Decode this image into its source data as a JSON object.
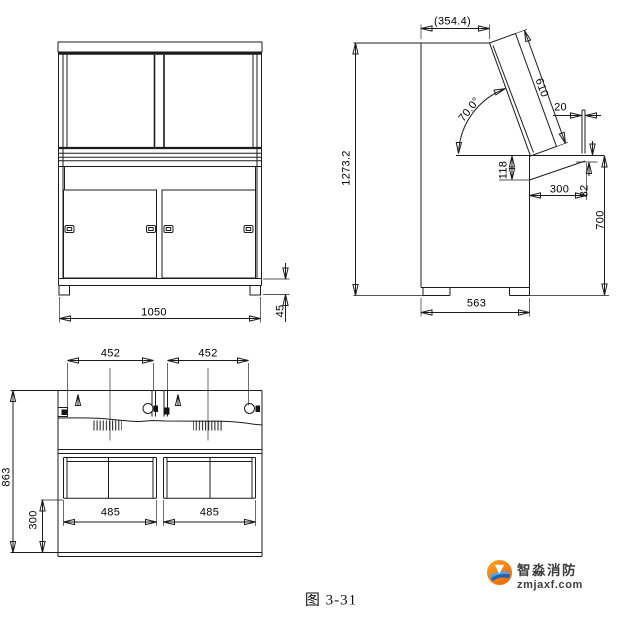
{
  "figure": {
    "caption": "图 3-31",
    "views": {
      "front": {
        "dims": {
          "overall_width": "1050",
          "plinth_height": "45"
        }
      },
      "side": {
        "dims": {
          "overall_height": "1273.2",
          "top_depth": "(354.4)",
          "panel_length": "610",
          "panel_angle": "70.0°",
          "back_gap": "20",
          "desk_drop": "118",
          "desk_depth": "300",
          "desk_edge": "32",
          "desk_height": "700",
          "overall_depth": "563"
        }
      },
      "top": {
        "dims": {
          "left_door_width": "452",
          "right_door_width": "452",
          "left_box_width": "485",
          "right_box_width": "485",
          "base_depth": "300",
          "overall_depth": "863"
        }
      }
    }
  },
  "watermark": {
    "brand": "智淼消防",
    "domain": "zmjaxf.com"
  },
  "colors": {
    "line": "#1c1c1c",
    "background": "#ffffff",
    "logo_orange": "#f68b1f",
    "logo_blue": "#2b7fd0",
    "logo_text": "#3d3d3d"
  }
}
